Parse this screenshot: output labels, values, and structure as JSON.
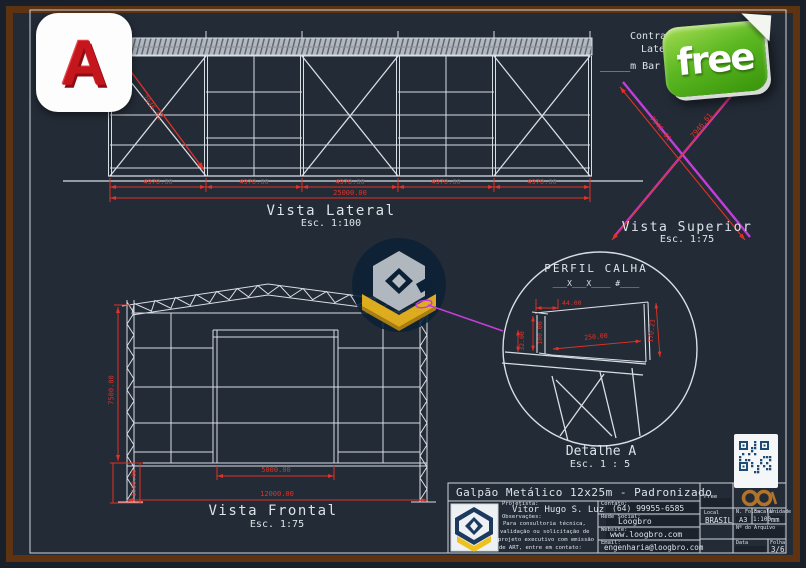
{
  "logos": {
    "autocad_letter": "A",
    "free_text": "free"
  },
  "lateral": {
    "title": "Vista Lateral",
    "scale": "Esc. 1:100",
    "bay_widths": [
      "4970.00",
      "4970.00",
      "4970.00",
      "4970.00",
      "4970.00"
    ],
    "total_width": "25000.00",
    "diagonal": "7946.61"
  },
  "superior": {
    "title": "Vista Superior",
    "scale": "Esc. 1:75",
    "diagonal_1": "7946.61",
    "diagonal_2": "7946.61",
    "note_line_1": "Contrav",
    "note_line_2": "Later",
    "note_line_3": "_____m Bar"
  },
  "frontal": {
    "title": "Vista Frontal",
    "scale": "Esc. 1:75",
    "height": "7500.00",
    "footing_height": "1500.00",
    "door_width": "5000.00",
    "total_width": "12000.00"
  },
  "detail": {
    "heading": "PERFIL CALHA",
    "subheading": "___X___X____  #____",
    "title": "Detalhe A",
    "scale": "Esc. 1 : 5",
    "dim_top": "44.00",
    "dim_web": "100.00",
    "dim_lip": "32.00",
    "dim_length": "250.00",
    "dim_flange": "170.23"
  },
  "title_block": {
    "title": "Galpão Metálico 12x25m - Padronizado",
    "projetista_label": "Projetista:",
    "projetista": "Vitor Hugo S. Luz",
    "contato_label": "Contato:",
    "contato": "(64) 99955-6585",
    "observacoes_label": "Observações:",
    "obs_line_1": "Para consultoria técnica,",
    "obs_line_2": "validação ou solicitação de",
    "obs_line_3": "projeto executivo com emissão",
    "obs_line_4": "de ART, entre em contato:",
    "rede_label": "Rede Social:",
    "rede": "Loogbro",
    "website_label": "Website:",
    "website": "www.loogbro.com",
    "email_label": "Email:",
    "email": "engenharia@loogbro.com",
    "free_label": "Free",
    "local_label": "Local",
    "local": "BRASIL",
    "formato_label": "N. Folha",
    "formato": "A3",
    "escala_label": "Escala",
    "escala": "1:100",
    "unidade_label": "Unidade",
    "unidade": "mm",
    "arquivo_label": "Nº do Arquivo",
    "data_label": "Data",
    "folha_label": "Folha",
    "folha": "3/6"
  }
}
